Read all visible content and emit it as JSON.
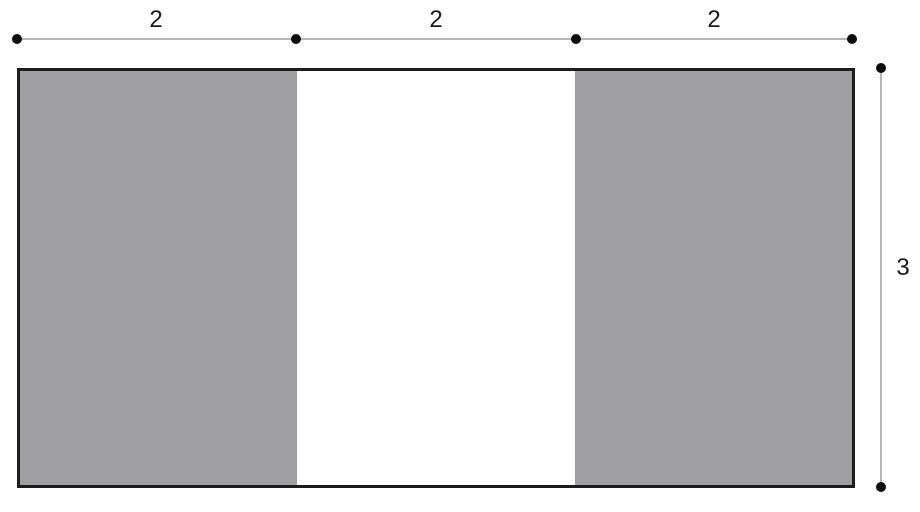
{
  "diagram": {
    "type": "geometry-figure",
    "shape": "rectangle divided into three equal vertical strips; left and right strips shaded, middle strip unshaded",
    "top_dimensions": {
      "segments": [
        {
          "label": "2"
        },
        {
          "label": "2"
        },
        {
          "label": "2"
        }
      ]
    },
    "side_dimension": {
      "label": "3"
    }
  },
  "colors": {
    "shaded_region": "#9f9fa1",
    "outline": "#1c1c1c",
    "dimension_line": "#b5b5b5",
    "marker_dot": "#0d0d0d",
    "background": "#ffffff",
    "label_text": "#1a1a1a"
  }
}
